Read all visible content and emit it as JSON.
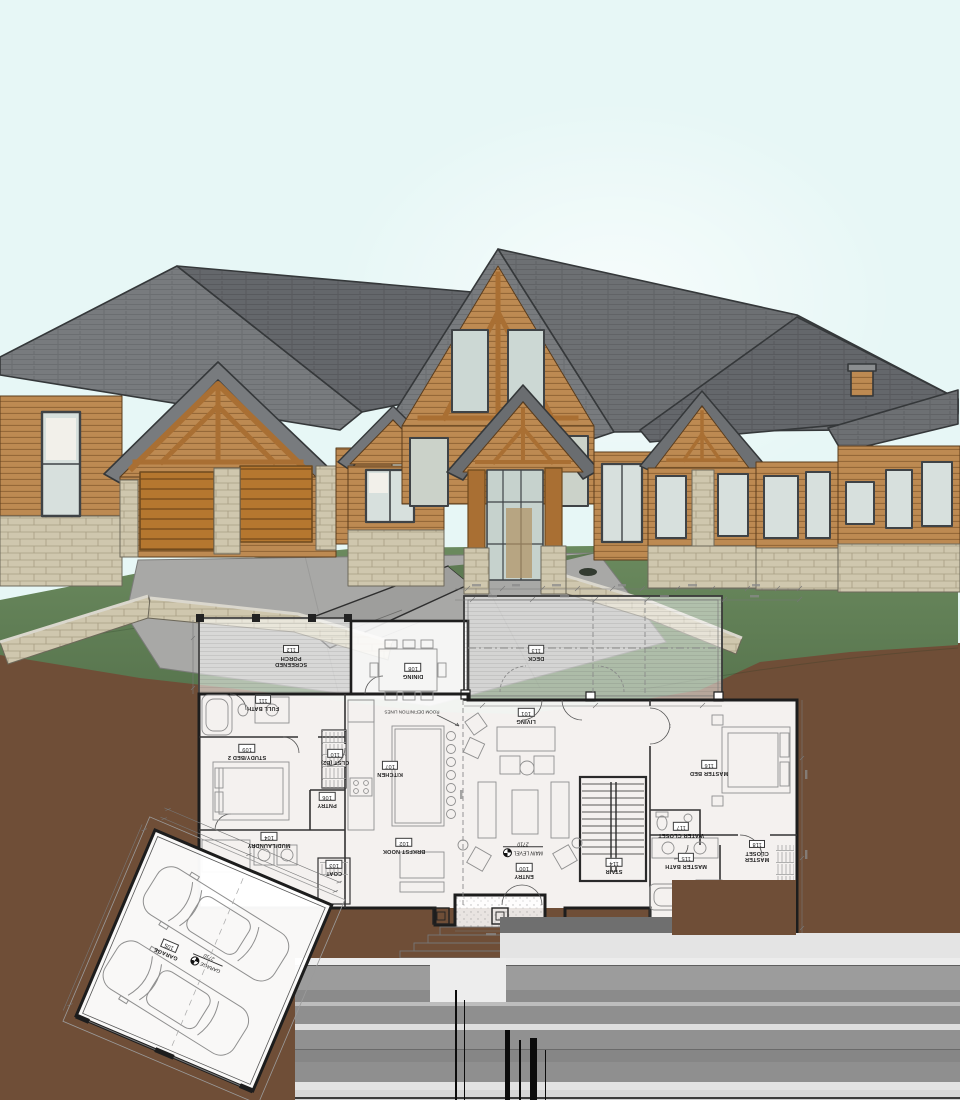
{
  "floor_plan": {
    "rooms": [
      {
        "name": "SCREENED PORCH",
        "number": "112"
      },
      {
        "name": "DINING",
        "number": "108"
      },
      {
        "name": "DECK",
        "number": "113"
      },
      {
        "name": "FULL BATH",
        "number": "111"
      },
      {
        "name": "LIVING",
        "number": "101"
      },
      {
        "name": "STUDY/BED 2",
        "number": "109"
      },
      {
        "name": "CLST (B2)",
        "number": "110"
      },
      {
        "name": "KITCHEN",
        "number": "107"
      },
      {
        "name": "MASTER BED",
        "number": "116"
      },
      {
        "name": "PNTRY",
        "number": "106"
      },
      {
        "name": "WATER CLOSET",
        "number": "117"
      },
      {
        "name": "MUD/LAUNDRY",
        "number": "104"
      },
      {
        "name": "BRKFST NOOK",
        "number": "102"
      },
      {
        "name": "MASTER CLOSET",
        "number": "118"
      },
      {
        "name": "MASTER BATH",
        "number": "115"
      },
      {
        "name": "COAT",
        "number": "103"
      },
      {
        "name": "ENTRY",
        "number": "100"
      },
      {
        "name": "STAIR",
        "number": "114"
      },
      {
        "name": "GARAGE",
        "number": "105"
      }
    ],
    "annotations": {
      "room_definition": "ROOM DEFINITION LINES",
      "main_level_label": "MAIN LEVEL",
      "main_level_elevation": "2710",
      "garage_level_label": "GARAGE",
      "garage_level_elevation": "2710"
    }
  },
  "colors": {
    "sky": "#e7f7f6",
    "roof": "#6f7275",
    "wood_siding": "#bd8a52",
    "timber": "#a96f33",
    "garage_door": "#b5772f",
    "stone": "#cfc7ae",
    "grass": "#5e7b53",
    "dirt": "#6f4e37",
    "driveway": "#a8a8a6",
    "plan_line": "#1d1d1d"
  }
}
